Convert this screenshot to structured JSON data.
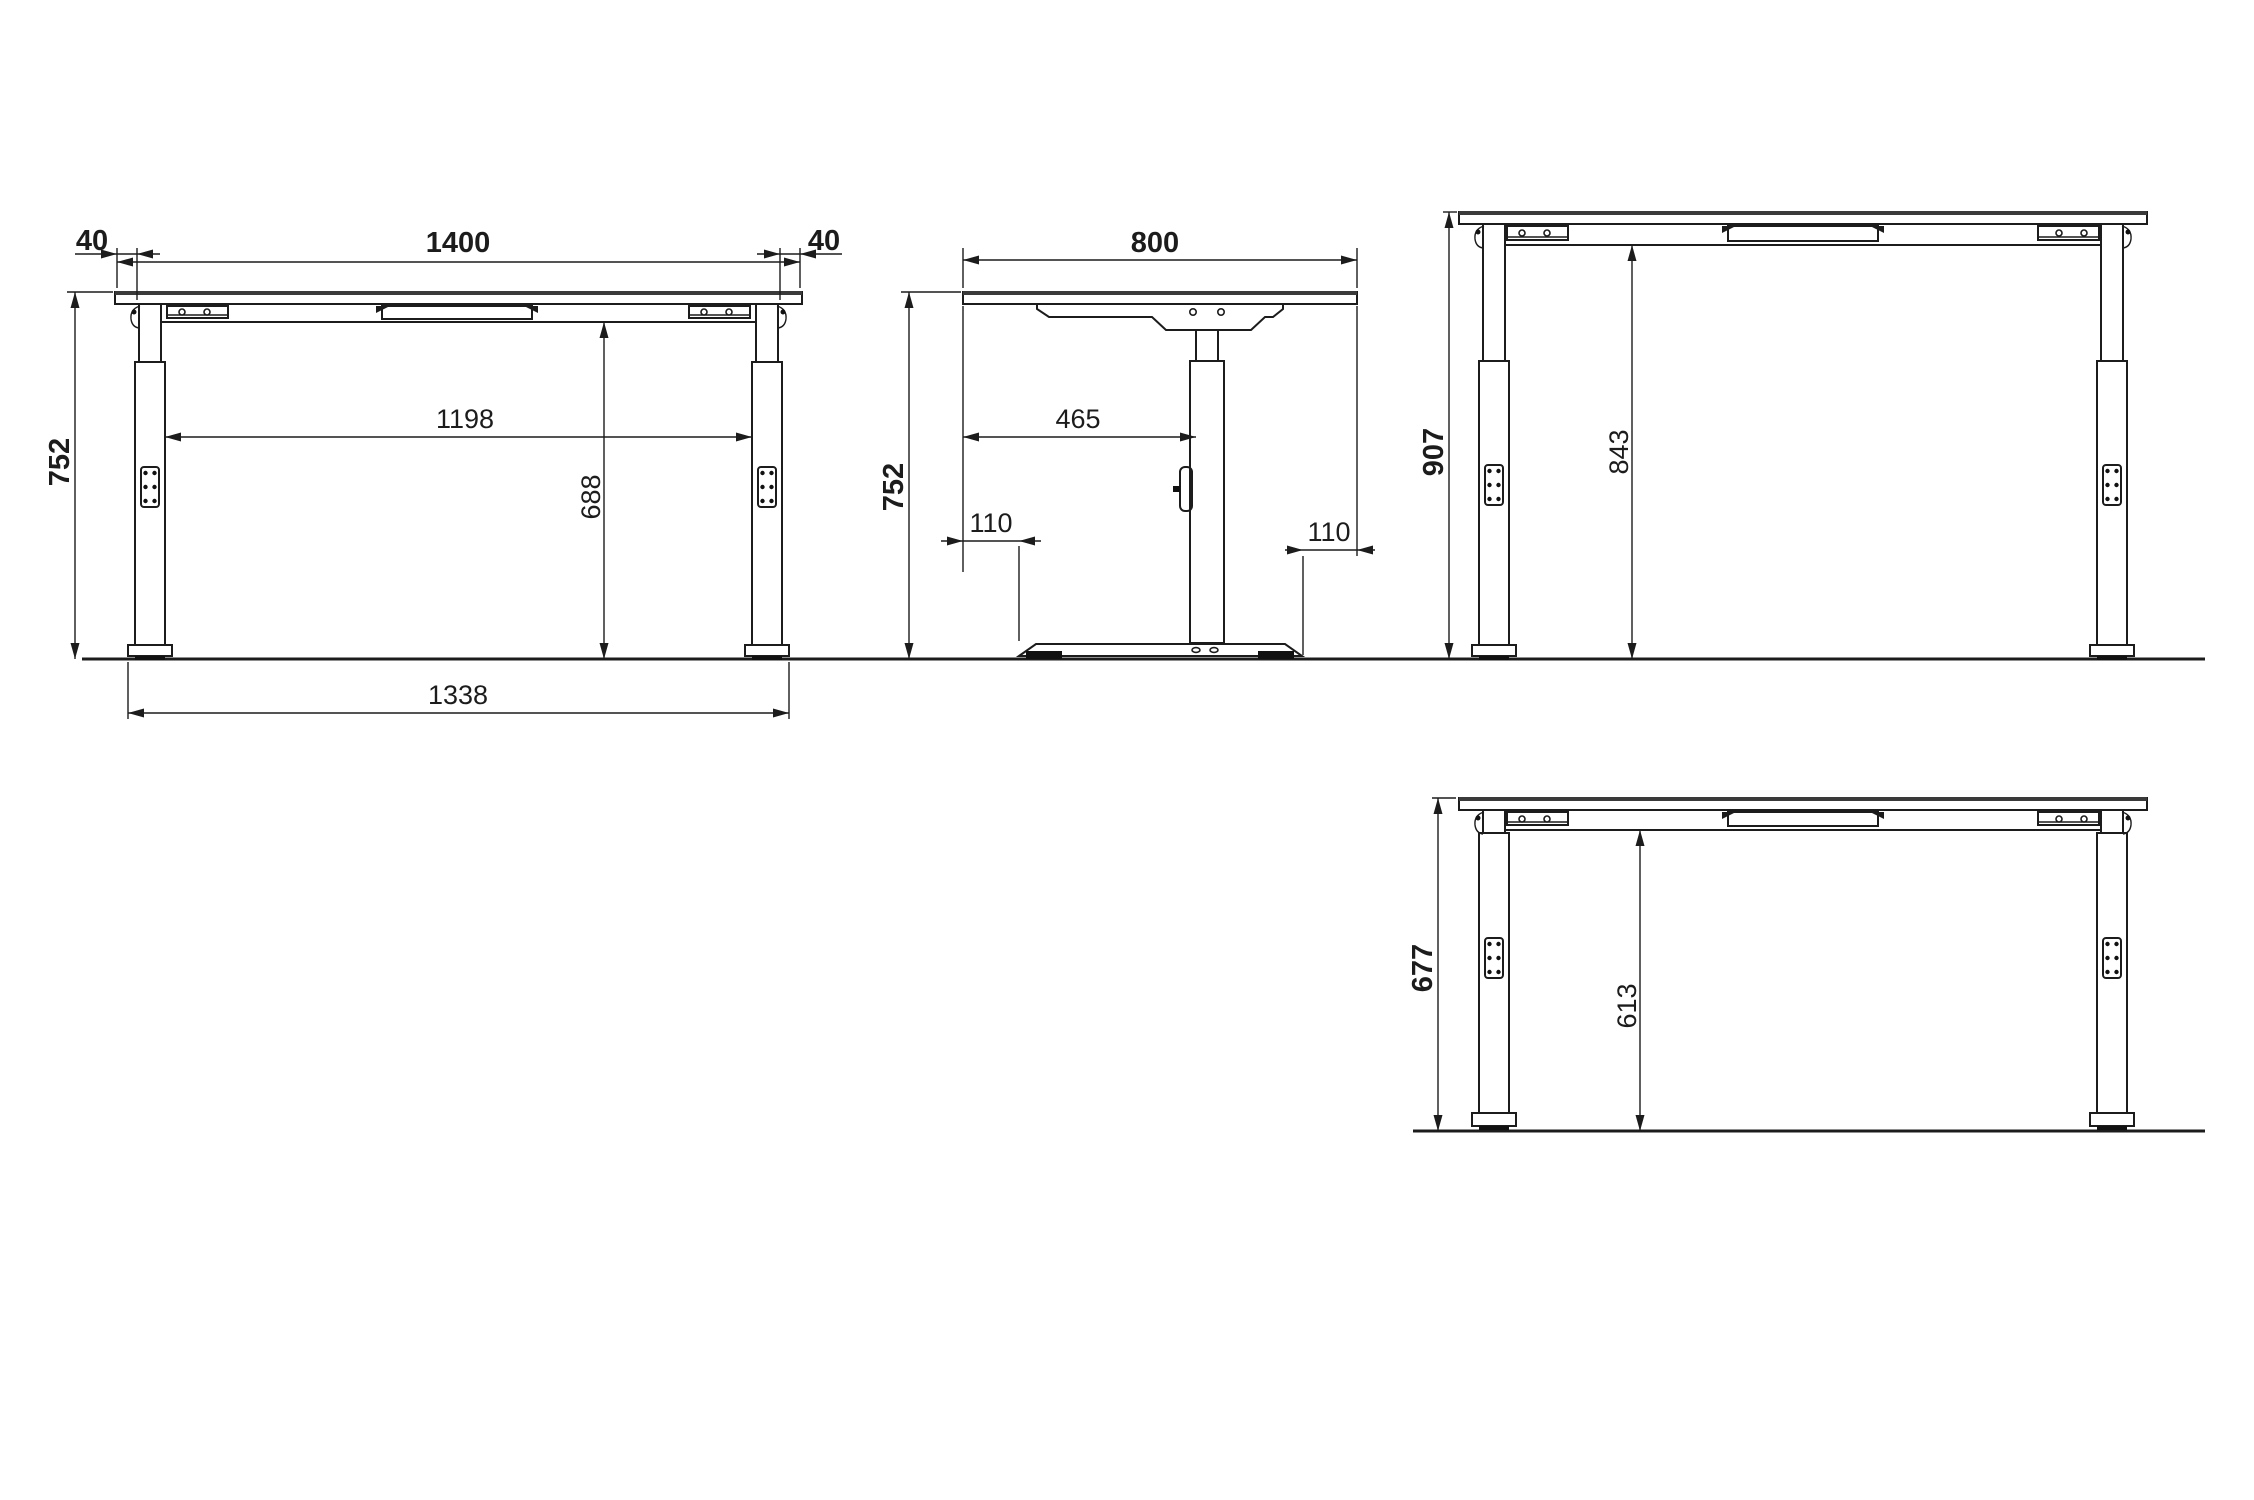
{
  "views": {
    "front_mid": {
      "overhang_left": "40",
      "top_width": "1400",
      "overhang_right": "40",
      "height": "752",
      "clear_width": "1198",
      "clear_height": "688",
      "base_width": "1338"
    },
    "side": {
      "depth": "800",
      "height": "752",
      "top_to_column": "465",
      "base_inset_left": "110",
      "base_inset_right": "110"
    },
    "front_raised": {
      "height": "907",
      "clear_height": "843"
    },
    "front_lowered": {
      "height": "677",
      "clear_height": "613"
    }
  },
  "colors": {
    "line": "#1c1c1c",
    "background": "#ffffff"
  }
}
